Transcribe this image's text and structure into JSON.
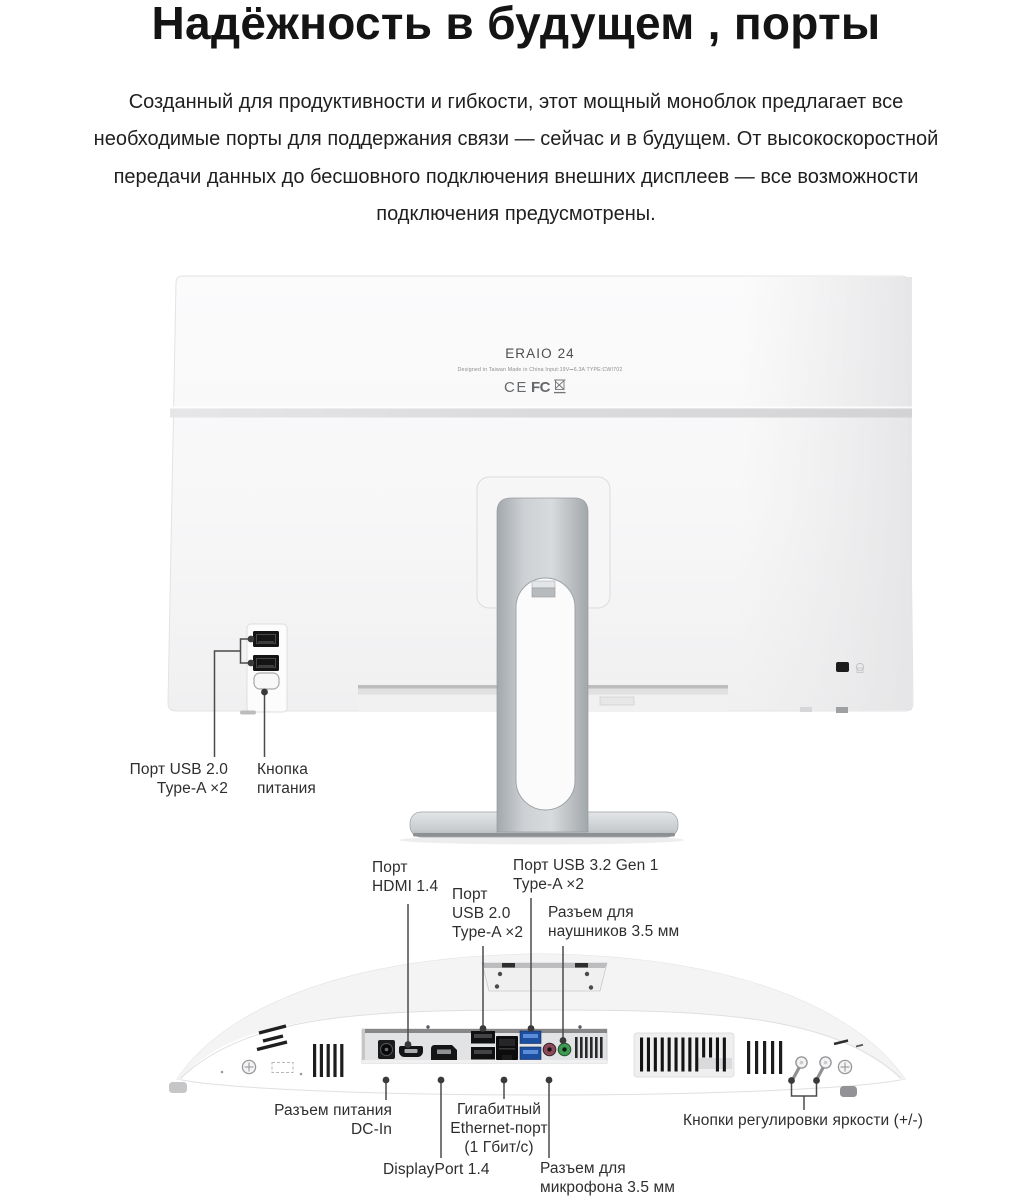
{
  "header": {
    "title": "Надёжность в будущем , порты",
    "intro_lines": [
      "Созданный для продуктивности и гибкости, этот мощный моноблок предлагает все",
      "необходимые порты для поддержания связи — сейчас и в будущем. От высокоскоростной",
      "передачи данных до бесшовного подключения внешних дисплеев — все возможности",
      "подключения предусмотрены."
    ]
  },
  "rear_view": {
    "model": "ERAIO 24",
    "regulatory": "Designed in Taiwan Made in China Input:19V⎓6.3A TYPE:CWI702",
    "ce_mark": "CE",
    "fcc_mark": "FC",
    "labels": {
      "usb": {
        "line1": "Порт USB 2.0",
        "line2": "Type-A ×2"
      },
      "power": {
        "line1": "Кнопка",
        "line2": "питания"
      }
    }
  },
  "bottom_view": {
    "labels": {
      "hdmi": {
        "line1": "Порт",
        "line2": "HDMI 1.4"
      },
      "usb20": {
        "line1": "Порт",
        "line2": "USB 2.0",
        "line3": "Type-A ×2"
      },
      "usb32": {
        "line1": "Порт USB 3.2 Gen 1",
        "line2": "Type-A ×2"
      },
      "headphones": {
        "line1": "Разъем для",
        "line2": "наушников 3.5 мм"
      },
      "dc_in": {
        "line1": "Разъем питания",
        "line2": "DC-In"
      },
      "ethernet": {
        "line1": "Гигабитный",
        "line2": "Ethernet-порт",
        "line3": "(1 Гбит/с)"
      },
      "displayport": {
        "line1": "DisplayPort 1.4"
      },
      "microphone": {
        "line1": "Разъем для",
        "line2": "микрофона 3.5 мм"
      },
      "brightness": {
        "line1": "Кнопки регулировки яркости (+/-)"
      }
    }
  },
  "colors": {
    "usb3_blue": "#1d4fa1",
    "usb3_tongue": "#5d8dd8",
    "mic_jack": "#8c4a58",
    "headphone_jack": "#3d9a50",
    "callout_line": "#4b4b4b",
    "callout_dot": "#3a3a3a",
    "stand_silver": "#b9bdc1"
  }
}
